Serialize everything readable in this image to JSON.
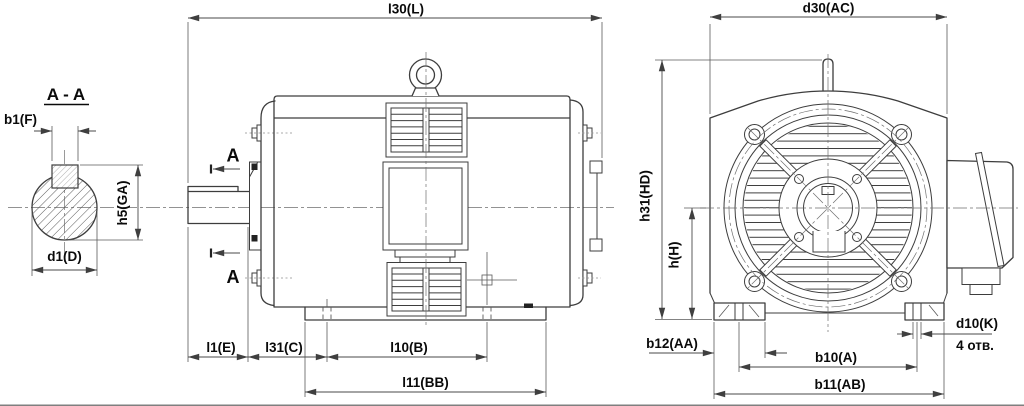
{
  "views": {
    "cross_section": {
      "title": "A - A",
      "dims": {
        "key_width": "b1(F)",
        "shaft_height_with_key": "h5(GA)",
        "shaft_diameter": "d1(D)"
      }
    },
    "side_view": {
      "section_letter": "A",
      "dims": {
        "total_length": "l30(L)",
        "shaft_extension_length": "l1(E)",
        "shoulder_length": "l31(C)",
        "foot_hole_spacing": "l10(B)",
        "base_length": "l11(BB)"
      }
    },
    "front_view": {
      "dims": {
        "body_diameter": "d30(AC)",
        "total_height": "h31(HD)",
        "axis_height": "h(H)",
        "foot_width": "b12(AA)",
        "foot_hole_span": "b10(A)",
        "feet_overall_width": "b11(AB)",
        "foot_hole_diameter": "d10(K)"
      },
      "holes_note": "4 отв."
    }
  },
  "colors": {
    "line": "#3d3d3d",
    "dimension_line": "#4a4a4a",
    "text": "#0a0a0a",
    "background": "#ffffff"
  }
}
